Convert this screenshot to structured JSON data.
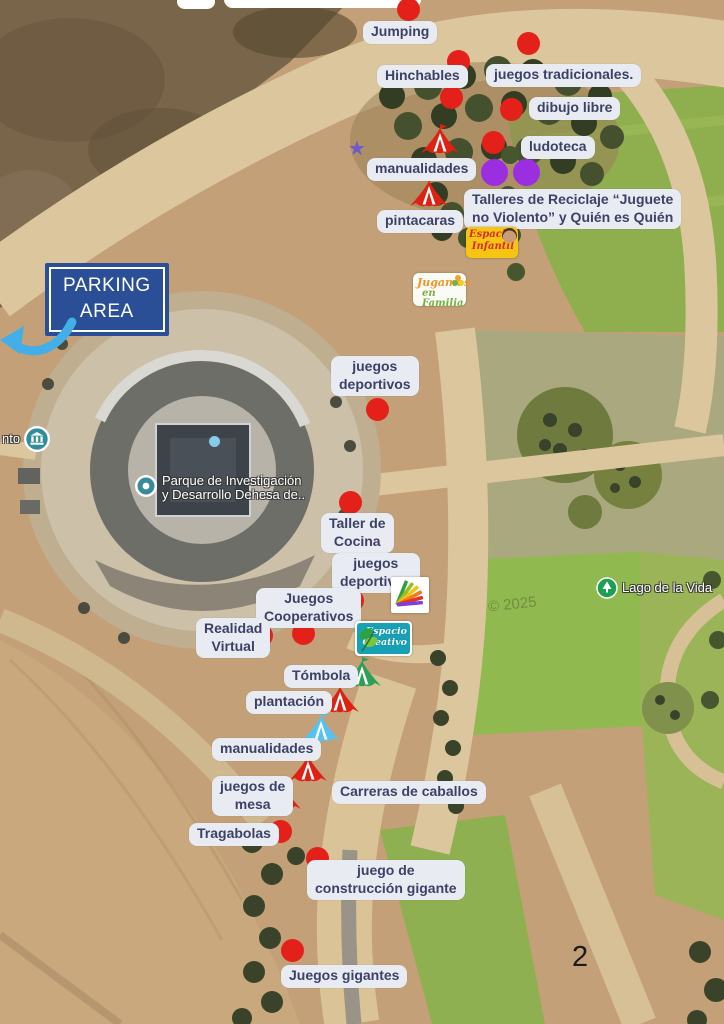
{
  "colors": {
    "marker_red": "#e3211a",
    "marker_purple": "#9a2ee0",
    "tent_red": "#df2114",
    "tent_green": "#2f9e57",
    "tent_blue": "#57c2ef",
    "star_purple": "#6f58c9",
    "arrow_blue": "#44aee9",
    "label_text": "#3d4166",
    "label_bg": "#e8ebf2",
    "parking_bg": "#2a4f97",
    "small_blue_dot": "#85cce9"
  },
  "page": {
    "number": "2"
  },
  "parking": {
    "lines": [
      "PARKING",
      "AREA"
    ]
  },
  "map_pois": {
    "park": {
      "lines": [
        "Parque de Investigación",
        "y Desarrollo Dehesa de.."
      ]
    },
    "lake": {
      "text": "Lago de la Vida"
    },
    "edge_partial": {
      "text": "nto"
    },
    "watermark": "© 2025"
  },
  "logos": {
    "espacio_infantil": {
      "lines": [
        "Espacio",
        "Infantil"
      ]
    },
    "jugamos_en_familia": {
      "lines": [
        "Jugamos",
        "en Familia"
      ]
    },
    "espacio_creativo": {
      "lines": [
        "Espacio",
        "Creativo"
      ]
    }
  },
  "labels": [
    {
      "id": "jumping",
      "lines": [
        "Jumping"
      ]
    },
    {
      "id": "hinchables",
      "lines": [
        "Hinchables"
      ]
    },
    {
      "id": "juegos-tradicionales",
      "lines": [
        "juegos tradicionales."
      ]
    },
    {
      "id": "dibujo-libre",
      "lines": [
        "dibujo libre"
      ]
    },
    {
      "id": "ludoteca",
      "lines": [
        "ludoteca"
      ]
    },
    {
      "id": "manualidades-1",
      "lines": [
        "manualidades"
      ]
    },
    {
      "id": "pintacaras",
      "lines": [
        "pintacaras"
      ]
    },
    {
      "id": "talleres-reciclaje",
      "lines": [
        "Talleres de Reciclaje “Juguete",
        "no Violento” y Quién es Quién"
      ]
    },
    {
      "id": "juegos-deportivos-1",
      "lines": [
        "juegos",
        "deportivos"
      ]
    },
    {
      "id": "taller-de-cocina",
      "lines": [
        "Taller de",
        "Cocina"
      ]
    },
    {
      "id": "juegos-deportivos-2",
      "lines": [
        "juegos",
        "deportivos"
      ]
    },
    {
      "id": "juegos-cooperativos",
      "lines": [
        "Juegos",
        "Cooperativos"
      ]
    },
    {
      "id": "realidad-virtual",
      "lines": [
        "Realidad",
        "Virtual"
      ]
    },
    {
      "id": "tombola",
      "lines": [
        "Tómbola"
      ]
    },
    {
      "id": "plantacion",
      "lines": [
        "plantación"
      ]
    },
    {
      "id": "manualidades-2",
      "lines": [
        "manualidades"
      ]
    },
    {
      "id": "juegos-de-mesa",
      "lines": [
        "juegos de",
        "mesa"
      ]
    },
    {
      "id": "carreras-de-caballos",
      "lines": [
        "Carreras de caballos"
      ]
    },
    {
      "id": "tragabolas",
      "lines": [
        "Tragabolas"
      ]
    },
    {
      "id": "juego-construccion-gigante",
      "lines": [
        "juego de",
        "construcción gigante"
      ]
    },
    {
      "id": "juegos-gigantes",
      "lines": [
        "Juegos gigantes"
      ]
    }
  ]
}
